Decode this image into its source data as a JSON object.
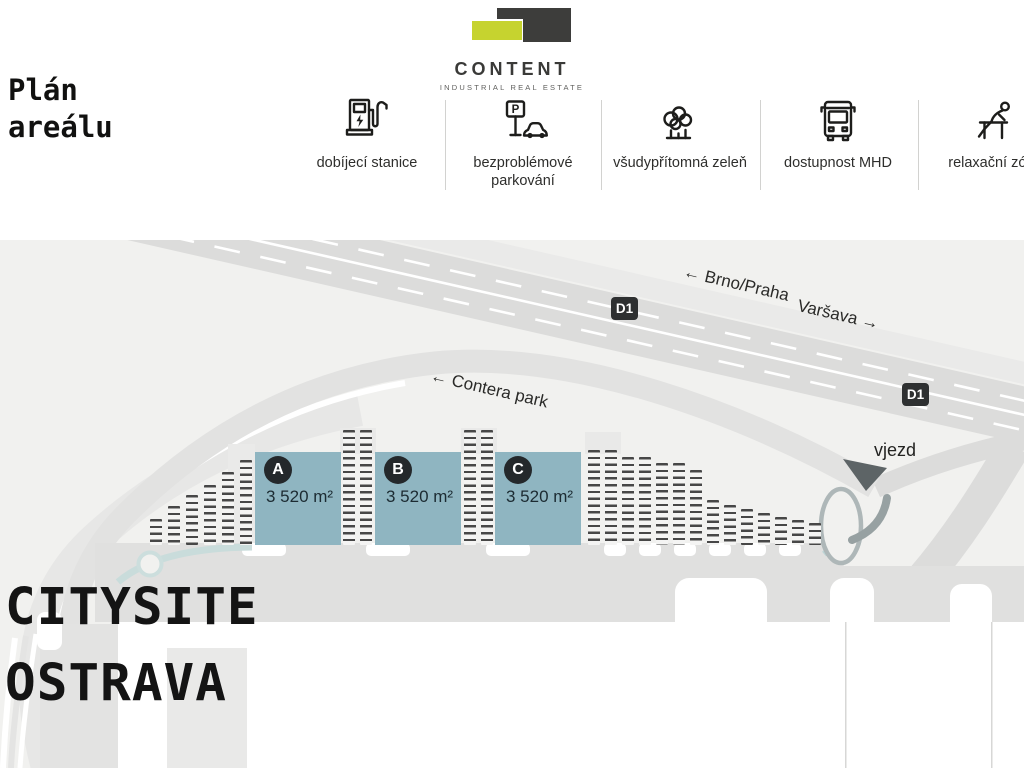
{
  "header": {
    "page_title": "Plán areálu",
    "logo": {
      "name": "CONTENT",
      "tagline": "INDUSTRIAL REAL ESTATE"
    },
    "features": [
      {
        "icon": "ev-charging-icon",
        "label": "dobíjecí stanice"
      },
      {
        "icon": "parking-icon",
        "label": "bezproblémové parkování",
        "sign_letter": "P"
      },
      {
        "icon": "greenery-icon",
        "label": "všudypřítomná zeleň"
      },
      {
        "icon": "bus-icon",
        "label": "dostupnost MHD"
      },
      {
        "icon": "relax-zone-icon",
        "label": "relaxační zóny"
      }
    ]
  },
  "map": {
    "labels": {
      "direction_west": "← Brno/Praha",
      "direction_east": "Varšava →",
      "access_road": "← Contera park",
      "entrance": "vjezd",
      "highway_badge_1": "D1",
      "highway_badge_2": "D1"
    },
    "buildings": [
      {
        "id": "A",
        "area": "3 520 m²"
      },
      {
        "id": "B",
        "area": "3 520 m²"
      },
      {
        "id": "C",
        "area": "3 520 m²"
      }
    ],
    "parking_columns": [
      [
        150,
        279
      ],
      [
        168,
        266
      ],
      [
        186,
        255
      ],
      [
        204,
        245
      ],
      [
        222,
        232
      ],
      [
        240,
        220
      ],
      [
        343,
        190
      ],
      [
        360,
        190
      ],
      [
        464,
        190
      ],
      [
        481,
        190
      ],
      [
        588,
        210
      ],
      [
        605,
        210
      ],
      [
        622,
        217
      ],
      [
        639,
        217
      ],
      [
        656,
        223
      ],
      [
        673,
        223
      ],
      [
        690,
        230
      ],
      [
        707,
        260
      ],
      [
        724,
        265
      ],
      [
        741,
        269
      ],
      [
        758,
        273
      ],
      [
        775,
        277
      ],
      [
        792,
        280
      ],
      [
        809,
        283
      ]
    ],
    "site_title": {
      "line1": "CITYSITE",
      "line2": "OSTRAVA"
    }
  },
  "colors": {
    "brand_yellow": "#c6d32f",
    "brand_dark": "#3d3d3b",
    "building_fill": "#8fb5c1",
    "building_badge": "#24282b",
    "highway_fill": "#dcdcdb",
    "badge_dark": "#2e3031",
    "map_background": "#f1f1ef"
  }
}
